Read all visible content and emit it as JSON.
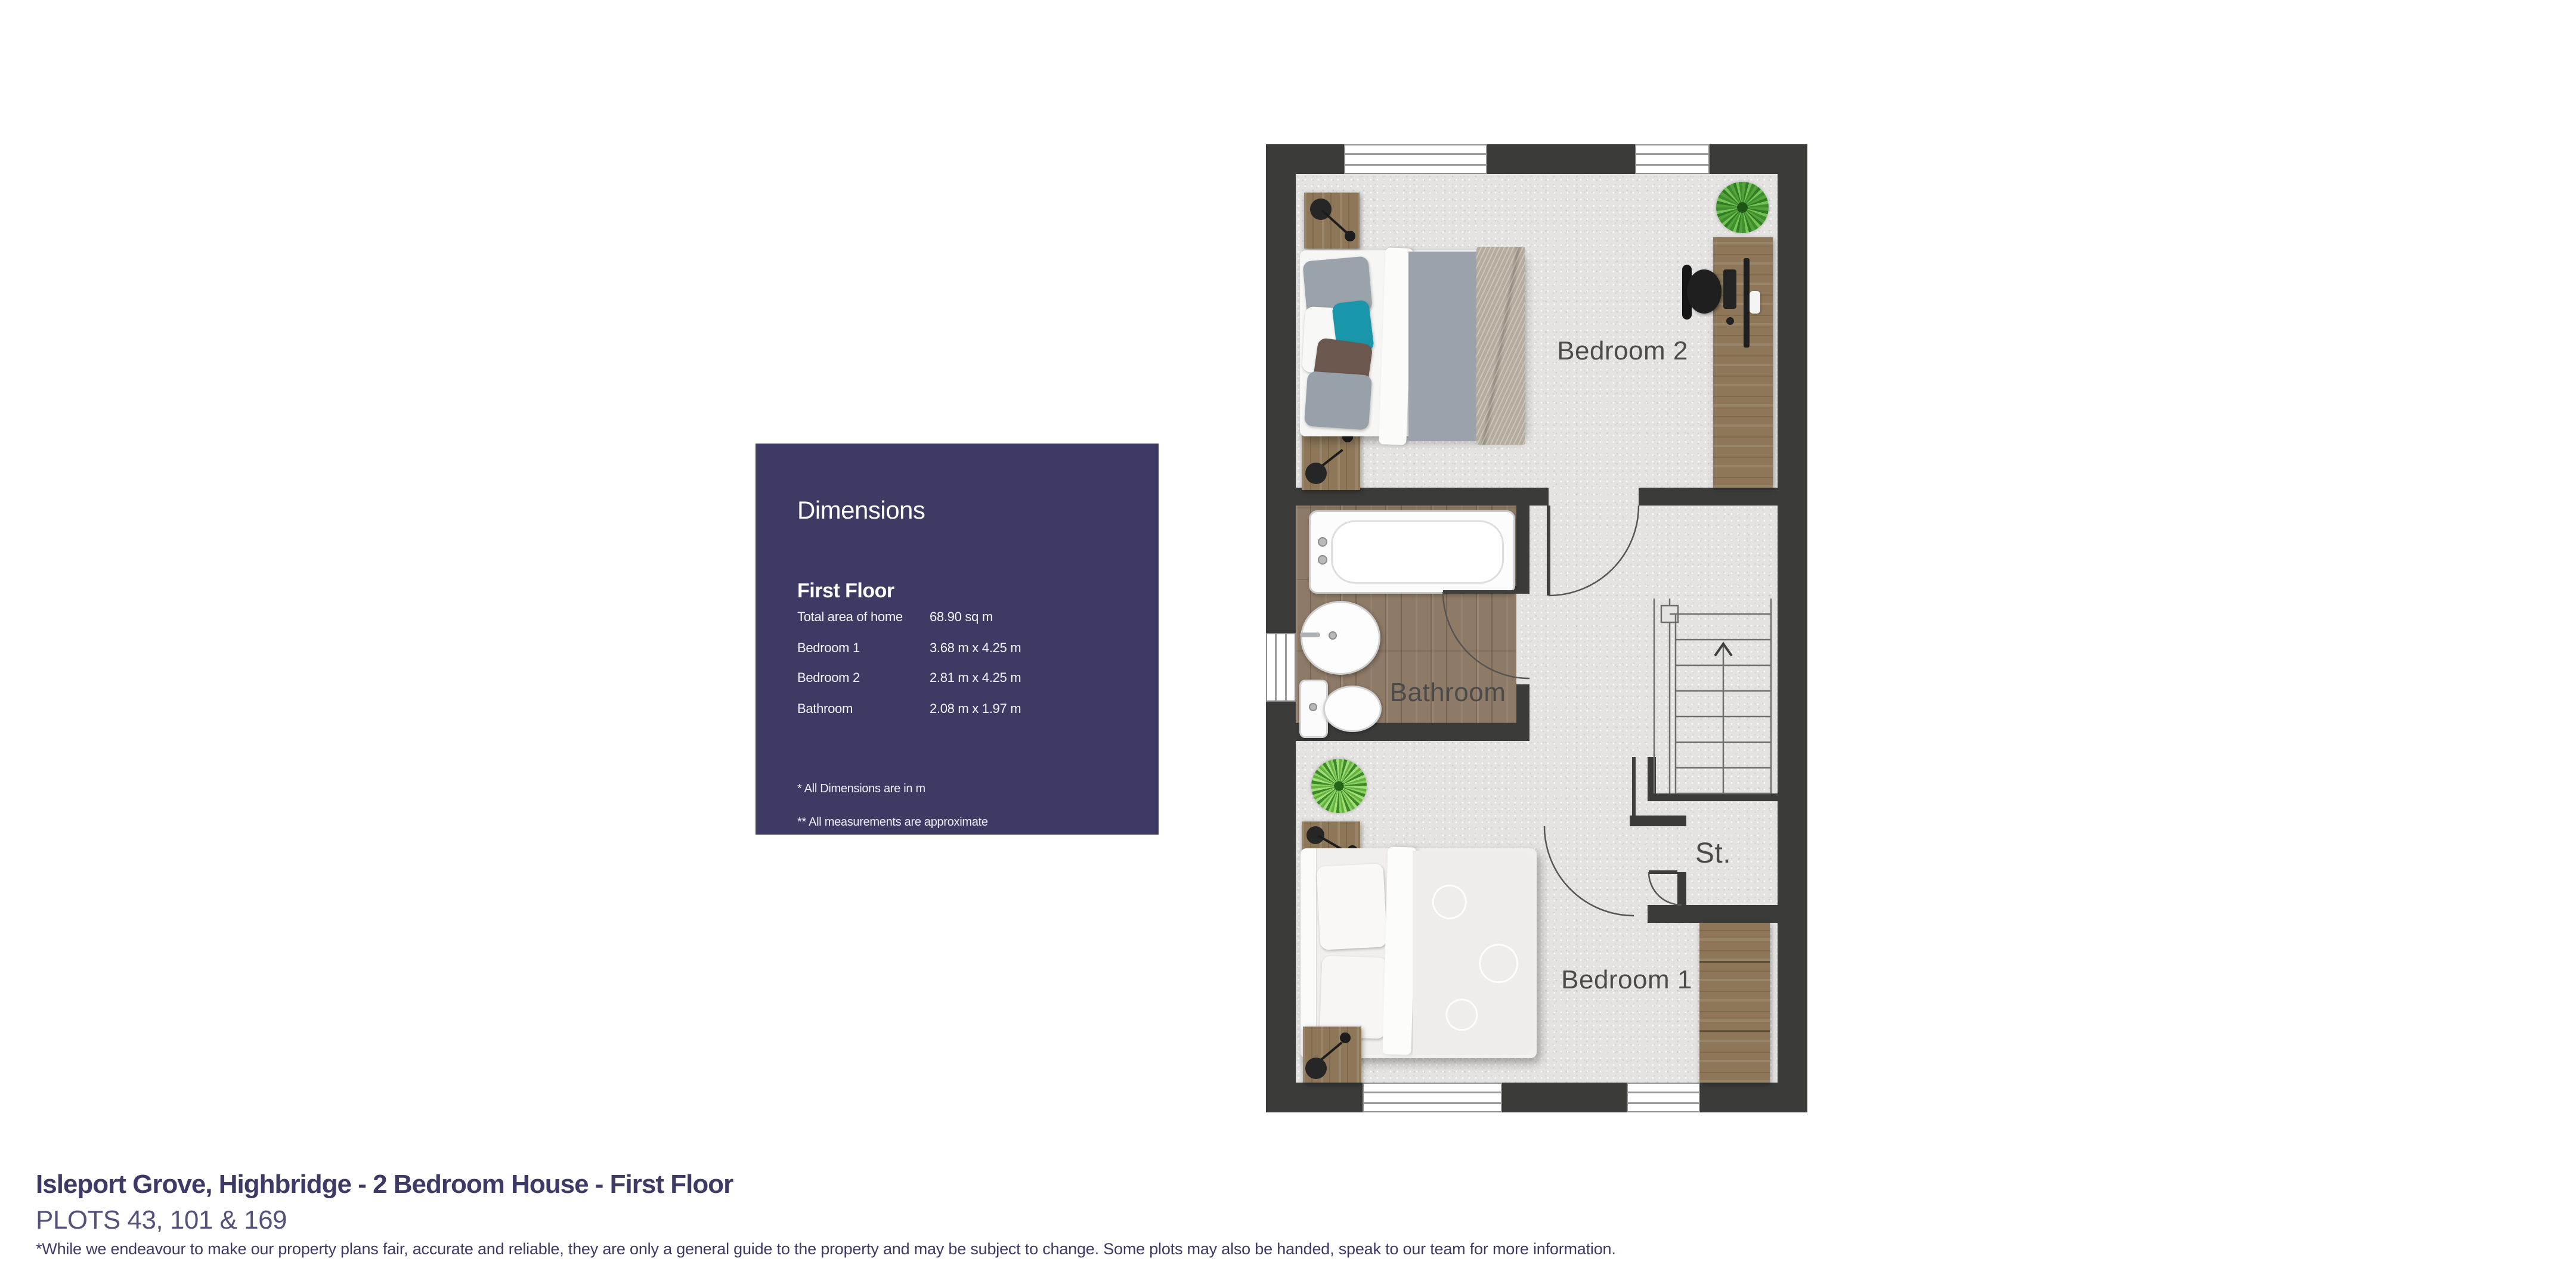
{
  "page": {
    "background": "#ffffff"
  },
  "dimensions_panel": {
    "title": "Dimensions",
    "section": "First Floor",
    "rows": [
      {
        "label": "Total area of home",
        "value": "68.90 sq m"
      },
      {
        "label": "Bedroom 1",
        "value": "3.68 m x 4.25 m"
      },
      {
        "label": "Bedroom 2",
        "value": "2.81 m x 4.25 m"
      },
      {
        "label": "Bathroom",
        "value": "2.08 m x 1.97 m"
      }
    ],
    "footnotes": [
      "* All Dimensions are in m",
      "** All measurements are approximate"
    ],
    "background": "#3d3a64",
    "text_color": "#ffffff"
  },
  "floorplan": {
    "labels": {
      "bedroom2": "Bedroom 2",
      "bathroom": "Bathroom",
      "storage": "St.",
      "bedroom1": "Bedroom 1"
    },
    "stairs_direction": "up",
    "wall_color": "#3b3b3a",
    "carpet_color": "#e4e3e1",
    "wood_floor_color": "#8e7b67"
  },
  "footer": {
    "title": "Isleport Grove, Highbridge - 2 Bedroom House - First Floor",
    "plots": "PLOTS 43, 101 & 169",
    "disclaimer": "*While we endeavour to make our property plans fair, accurate and reliable, they are only a general guide to the property and may be subject to change. Some plots may also be handed, speak to our team for more information.",
    "title_color": "#3e3a68"
  }
}
